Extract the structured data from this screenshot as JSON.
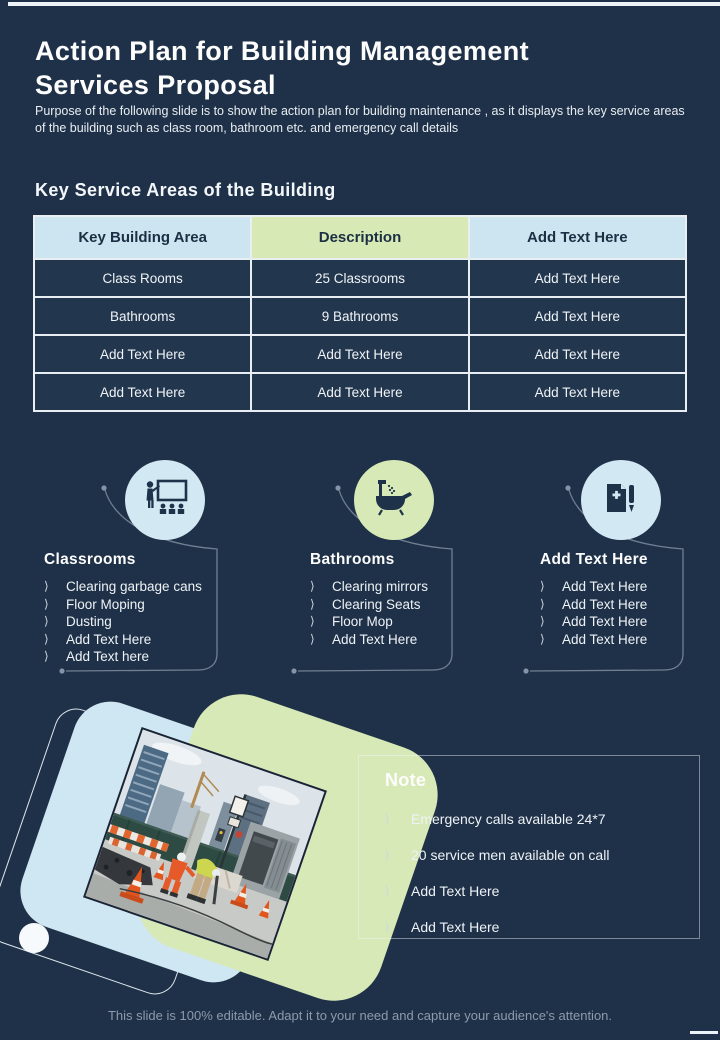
{
  "slide": {
    "title": "Action Plan for Building Management Services Proposal",
    "purpose": "Purpose of the following slide is to show the action plan for building maintenance , as it displays the key service areas of the building such as class room, bathroom etc. and emergency call details",
    "section_heading": "Key Service Areas of the Building",
    "footer": "This slide is 100% editable. Adapt it to your need and capture your audience's attention."
  },
  "glyphs": {
    "bullet": "⟩"
  },
  "table": {
    "headers": [
      "Key Building Area",
      "Description",
      "Add Text Here"
    ],
    "rows": [
      [
        "Class Rooms",
        "25 Classrooms",
        "Add Text Here"
      ],
      [
        "Bathrooms",
        "9 Bathrooms",
        "Add Text Here"
      ],
      [
        "Add Text Here",
        "Add Text Here",
        "Add Text Here"
      ],
      [
        "Add Text Here",
        "Add Text Here",
        "Add Text Here"
      ]
    ]
  },
  "service_areas": [
    {
      "title": "Classrooms",
      "icon": "classroom-presentation-icon",
      "circle_color": "#d2e8f3",
      "items": [
        "Clearing garbage cans",
        "Floor Moping",
        "Dusting",
        "Add Text Here",
        "Add Text here"
      ]
    },
    {
      "title": "Bathrooms",
      "icon": "bathtub-shower-icon",
      "circle_color": "#d8e9b8",
      "items": [
        "Clearing mirrors",
        "Clearing Seats",
        "Floor Mop",
        "Add Text Here"
      ]
    },
    {
      "title": "Add Text Here",
      "icon": "document-pen-icon",
      "circle_color": "#d2e8f3",
      "items": [
        "Add Text Here",
        "Add Text Here",
        "Add Text Here",
        "Add Text Here"
      ]
    }
  ],
  "note": {
    "title": "Note",
    "items": [
      "Emergency calls available 24*7",
      "20 service men available on call",
      "Add Text Here",
      "Add Text Here"
    ]
  },
  "colors": {
    "background": "#1f3148",
    "light_blue": "#cfe7f2",
    "light_green": "#d8e9b8",
    "header_text": "#1c2f44",
    "footer_text": "#8e9aab"
  }
}
